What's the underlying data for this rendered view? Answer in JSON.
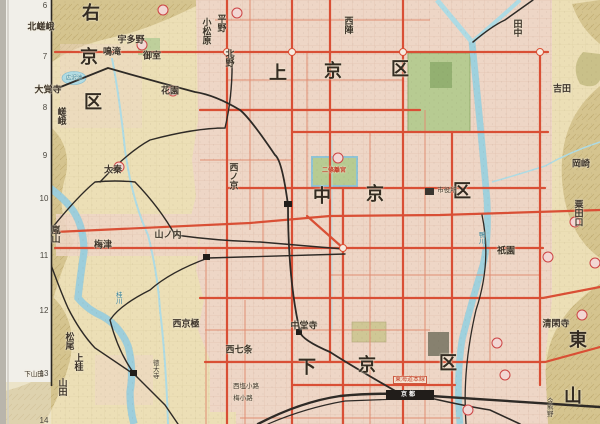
{
  "map": {
    "type": "city-map",
    "description": "Historical street map of Kyoto with ward names, district labels, rivers, tram and rail lines",
    "palette": {
      "field": "#ecdfb6",
      "urban": "#eed6c6",
      "hill": "#d5c48f",
      "water": "#aedbe4",
      "park": "#b7cb92",
      "road_major": "#d94f35",
      "road_minor": "#e08d72",
      "rail": "#2e2a26",
      "margin": "#f1efe9",
      "marker_fill": "#f2d7d4",
      "marker_stroke": "#cc4444"
    },
    "margin_rows": [
      {
        "n": "6",
        "x": 45,
        "y": 6
      },
      {
        "n": "7",
        "x": 45,
        "y": 57
      },
      {
        "n": "8",
        "x": 45,
        "y": 108
      },
      {
        "n": "9",
        "x": 45,
        "y": 156
      },
      {
        "n": "10",
        "x": 44,
        "y": 199
      },
      {
        "n": "11",
        "x": 44,
        "y": 256
      },
      {
        "n": "12",
        "x": 44,
        "y": 311
      },
      {
        "n": "13",
        "x": 44,
        "y": 374
      },
      {
        "n": "14",
        "x": 44,
        "y": 421
      }
    ],
    "labels": [
      {
        "n": "ward-ukyo-1",
        "t": "右",
        "x": 91,
        "y": 14,
        "k": "xl"
      },
      {
        "n": "ward-ukyo-2",
        "t": "京",
        "x": 89,
        "y": 58,
        "k": "xl"
      },
      {
        "n": "ward-ukyo-3",
        "t": "区",
        "x": 93,
        "y": 103,
        "k": "xl"
      },
      {
        "n": "ward-kamigyo-1",
        "t": "上",
        "x": 278,
        "y": 74,
        "k": "xl"
      },
      {
        "n": "ward-kamigyo-2",
        "t": "京",
        "x": 333,
        "y": 72,
        "k": "xl"
      },
      {
        "n": "ward-kamigyo-3",
        "t": "区",
        "x": 400,
        "y": 70,
        "k": "xl"
      },
      {
        "n": "ward-nakagyo-1",
        "t": "中",
        "x": 322,
        "y": 197,
        "k": "xl"
      },
      {
        "n": "ward-nakagyo-2",
        "t": "京",
        "x": 375,
        "y": 195,
        "k": "xl"
      },
      {
        "n": "ward-nakagyo-3",
        "t": "区",
        "x": 462,
        "y": 192,
        "k": "xl"
      },
      {
        "n": "ward-shimogyo-1",
        "t": "下",
        "x": 307,
        "y": 368,
        "k": "xl"
      },
      {
        "n": "ward-shimogyo-2",
        "t": "京",
        "x": 367,
        "y": 366,
        "k": "xl"
      },
      {
        "n": "ward-shimogyo-3",
        "t": "区",
        "x": 448,
        "y": 364,
        "k": "xl"
      },
      {
        "n": "ward-higashiyama-1",
        "t": "東",
        "x": 578,
        "y": 341,
        "k": "xl"
      },
      {
        "n": "ward-higashiyama-2",
        "t": "山",
        "x": 573,
        "y": 397,
        "k": "xl"
      },
      {
        "n": "area-kitasaga",
        "t": "北嵯峨",
        "x": 41,
        "y": 28,
        "k": "area"
      },
      {
        "n": "area-daikakuji",
        "t": "大覚寺",
        "x": 48,
        "y": 91,
        "k": "area"
      },
      {
        "n": "area-saga",
        "t": "嵯峨",
        "x": 60,
        "y": 116,
        "k": "areav"
      },
      {
        "n": "area-narutaki",
        "t": "鳴滝",
        "x": 112,
        "y": 53,
        "k": "area"
      },
      {
        "n": "area-utano",
        "t": "宇多野",
        "x": 131,
        "y": 41,
        "k": "area"
      },
      {
        "n": "area-omuro",
        "t": "御室",
        "x": 152,
        "y": 57,
        "k": "area"
      },
      {
        "n": "area-hanazono",
        "t": "花園",
        "x": 170,
        "y": 92,
        "k": "area"
      },
      {
        "n": "area-hirano",
        "t": "平野",
        "x": 220,
        "y": 23,
        "k": "areav"
      },
      {
        "n": "area-komatsubara",
        "t": "小松原",
        "x": 205,
        "y": 31,
        "k": "areav"
      },
      {
        "n": "area-kitano",
        "t": "北野",
        "x": 228,
        "y": 58,
        "k": "areav"
      },
      {
        "n": "area-nishijin",
        "t": "西陣",
        "x": 347,
        "y": 25,
        "k": "areav"
      },
      {
        "n": "area-tanaka",
        "t": "田中",
        "x": 516,
        "y": 28,
        "k": "areav"
      },
      {
        "n": "area-yoshida",
        "t": "吉田",
        "x": 562,
        "y": 90,
        "k": "area"
      },
      {
        "n": "area-okazaki",
        "t": "岡崎",
        "x": 581,
        "y": 165,
        "k": "area"
      },
      {
        "n": "area-awataguchi",
        "t": "粟田口",
        "x": 577,
        "y": 213,
        "k": "areav"
      },
      {
        "n": "area-gion",
        "t": "祇園",
        "x": 506,
        "y": 252,
        "k": "area"
      },
      {
        "n": "area-nishinokyo",
        "t": "西ノ京",
        "x": 232,
        "y": 176,
        "k": "areav"
      },
      {
        "n": "area-uzumasa",
        "t": "太秦",
        "x": 113,
        "y": 171,
        "k": "area"
      },
      {
        "n": "area-yamanouchi",
        "t": "山ノ内",
        "x": 168,
        "y": 236,
        "k": "area"
      },
      {
        "n": "area-umezu",
        "t": "梅津",
        "x": 103,
        "y": 246,
        "k": "area"
      },
      {
        "n": "area-arashiyama",
        "t": "嵐山",
        "x": 54,
        "y": 234,
        "k": "areav"
      },
      {
        "n": "area-matsuo",
        "t": "松尾",
        "x": 68,
        "y": 341,
        "k": "areav"
      },
      {
        "n": "area-kamikatsura",
        "t": "上桂",
        "x": 77,
        "y": 362,
        "k": "areav"
      },
      {
        "n": "area-yamada",
        "t": "山田",
        "x": 61,
        "y": 387,
        "k": "areav"
      },
      {
        "n": "area-shimoyamada",
        "t": "下山田",
        "x": 34,
        "y": 374,
        "k": "sm"
      },
      {
        "n": "area-nishikyogoku",
        "t": "西京極",
        "x": 186,
        "y": 325,
        "k": "area"
      },
      {
        "n": "area-tokudaiji",
        "t": "徳大寺",
        "x": 155,
        "y": 369,
        "k": "smv"
      },
      {
        "n": "area-nishishichijo",
        "t": "西七条",
        "x": 239,
        "y": 351,
        "k": "area"
      },
      {
        "n": "area-chudoji",
        "t": "中堂寺",
        "x": 304,
        "y": 327,
        "k": "area"
      },
      {
        "n": "area-nishishiokoji",
        "t": "西塩小路",
        "x": 246,
        "y": 386,
        "k": "sm"
      },
      {
        "n": "area-umekoji",
        "t": "梅小路",
        "x": 243,
        "y": 398,
        "k": "sm"
      },
      {
        "n": "area-seikanji",
        "t": "清閑寺",
        "x": 556,
        "y": 325,
        "k": "area"
      },
      {
        "n": "area-imakumano",
        "t": "今熊野",
        "x": 549,
        "y": 407,
        "k": "smv"
      },
      {
        "n": "site-nijo-palace",
        "t": "二條離宮",
        "x": 334,
        "y": 171,
        "k": "red"
      },
      {
        "n": "site-city-hall",
        "t": "市役所",
        "x": 447,
        "y": 190,
        "k": "sm"
      },
      {
        "n": "water-hirosawa-pond",
        "t": "広沢池",
        "x": 74,
        "y": 79,
        "k": "water"
      },
      {
        "n": "water-kamo-river",
        "t": "鴨川",
        "x": 481,
        "y": 238,
        "k": "waterv"
      },
      {
        "n": "water-katsura-river",
        "t": "桂川",
        "x": 118,
        "y": 298,
        "k": "waterv"
      },
      {
        "n": "rail-tokaido-line",
        "t": "東海道本線",
        "x": 410,
        "y": 380,
        "k": "redbox"
      },
      {
        "n": "station-kyoto",
        "t": "京都",
        "x": 409,
        "y": 395,
        "k": "station"
      }
    ]
  }
}
